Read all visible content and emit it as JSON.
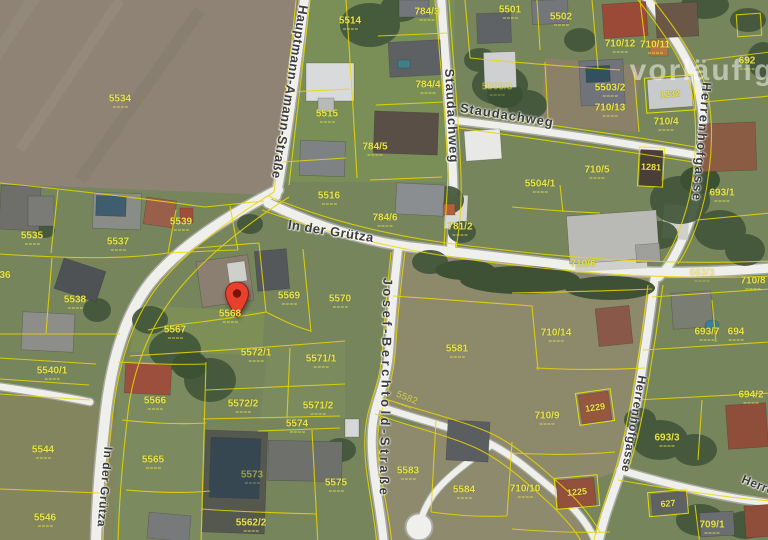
{
  "map": {
    "watermark": {
      "text": "vorläufig",
      "x": 702,
      "y": 71
    },
    "marker": {
      "x": 224,
      "y": 281
    },
    "streets": [
      {
        "name": "Hauptmann-Amann-Straße",
        "x": 290,
        "y": 92,
        "rot": 99,
        "fs": 13,
        "ls": 0.5
      },
      {
        "name": "Staudachweg",
        "x": 452,
        "y": 116,
        "rot": 87,
        "fs": 13,
        "ls": 1
      },
      {
        "name": "Staudachweg",
        "x": 507,
        "y": 115,
        "rot": 9,
        "fs": 13,
        "ls": 1
      },
      {
        "name": "In der Grütza",
        "x": 331,
        "y": 231,
        "rot": 9,
        "fs": 13,
        "ls": 0.5
      },
      {
        "name": "In der Grütza",
        "x": 105,
        "y": 487,
        "rot": 95,
        "fs": 12,
        "ls": 0.5
      },
      {
        "name": "Josef-Berchtold-Straße",
        "x": 386,
        "y": 388,
        "rot": 91,
        "fs": 13,
        "ls": 3.5
      },
      {
        "name": "Herrenhofgasse",
        "x": 702,
        "y": 142,
        "rot": 95,
        "fs": 13,
        "ls": 1.5
      },
      {
        "name": "Herrenhofgasse",
        "x": 634,
        "y": 424,
        "rot": 100,
        "fs": 12,
        "ls": 0.5
      },
      {
        "name": "Herrenhofgasse",
        "x": 788,
        "y": 497,
        "rot": 22,
        "fs": 12,
        "ls": 0.5
      }
    ],
    "parcels": [
      {
        "num": "5534",
        "x": 120,
        "y": 101
      },
      {
        "num": "5514",
        "x": 350,
        "y": 23
      },
      {
        "num": "5515",
        "x": 327,
        "y": 116
      },
      {
        "num": "5516",
        "x": 329,
        "y": 198
      },
      {
        "num": "784/3",
        "x": 427,
        "y": 14
      },
      {
        "num": "784/4",
        "x": 428,
        "y": 87
      },
      {
        "num": "784/5",
        "x": 375,
        "y": 149
      },
      {
        "num": "784/6",
        "x": 385,
        "y": 220
      },
      {
        "num": "781/2",
        "x": 460,
        "y": 229
      },
      {
        "num": "5501",
        "x": 510,
        "y": 12
      },
      {
        "num": "5502",
        "x": 561,
        "y": 19
      },
      {
        "num": "5503/3",
        "x": 497,
        "y": 89,
        "dim": true
      },
      {
        "num": "5503/2",
        "x": 610,
        "y": 90
      },
      {
        "num": "710/12",
        "x": 620,
        "y": 46
      },
      {
        "num": "710/11",
        "x": 655,
        "y": 47
      },
      {
        "num": "710/13",
        "x": 610,
        "y": 110
      },
      {
        "num": "710/4",
        "x": 666,
        "y": 124
      },
      {
        "num": "710/5",
        "x": 597,
        "y": 172
      },
      {
        "num": "692",
        "x": 747,
        "y": 63
      },
      {
        "num": "693/1",
        "x": 722,
        "y": 195
      },
      {
        "num": "5504/1",
        "x": 540,
        "y": 186
      },
      {
        "num": "710/6",
        "x": 583,
        "y": 266
      },
      {
        "num": "683/3",
        "x": 702,
        "y": 275,
        "dim": true
      },
      {
        "num": "710/8",
        "x": 753,
        "y": 283
      },
      {
        "num": "710/14",
        "x": 556,
        "y": 335
      },
      {
        "num": "693/7",
        "x": 707,
        "y": 334
      },
      {
        "num": "694",
        "x": 736,
        "y": 334
      },
      {
        "num": "5581",
        "x": 457,
        "y": 351
      },
      {
        "num": "5567",
        "x": 175,
        "y": 332
      },
      {
        "num": "5568",
        "x": 230,
        "y": 316
      },
      {
        "num": "5569",
        "x": 289,
        "y": 298
      },
      {
        "num": "5570",
        "x": 340,
        "y": 301
      },
      {
        "num": "5535",
        "x": 32,
        "y": 238
      },
      {
        "num": "36",
        "x": 5,
        "y": 276,
        "dash": false
      },
      {
        "num": "5537",
        "x": 118,
        "y": 244
      },
      {
        "num": "5538",
        "x": 75,
        "y": 302
      },
      {
        "num": "5539",
        "x": 181,
        "y": 224
      },
      {
        "num": "5540/1",
        "x": 52,
        "y": 373
      },
      {
        "num": "5544",
        "x": 43,
        "y": 452
      },
      {
        "num": "5546",
        "x": 45,
        "y": 520
      },
      {
        "num": "5565",
        "x": 153,
        "y": 462
      },
      {
        "num": "5566",
        "x": 155,
        "y": 403
      },
      {
        "num": "5571/1",
        "x": 321,
        "y": 361
      },
      {
        "num": "5571/2",
        "x": 318,
        "y": 408
      },
      {
        "num": "5572/1",
        "x": 256,
        "y": 355
      },
      {
        "num": "5572/2",
        "x": 243,
        "y": 406
      },
      {
        "num": "5573",
        "x": 252,
        "y": 477,
        "dim": true
      },
      {
        "num": "5574",
        "x": 297,
        "y": 426
      },
      {
        "num": "5575",
        "x": 336,
        "y": 485
      },
      {
        "num": "5582",
        "x": 406,
        "y": 400,
        "rot": 22,
        "dim": true
      },
      {
        "num": "5583",
        "x": 408,
        "y": 473
      },
      {
        "num": "5584",
        "x": 464,
        "y": 492
      },
      {
        "num": "5562/2",
        "x": 251,
        "y": 525
      },
      {
        "num": "710/9",
        "x": 547,
        "y": 418
      },
      {
        "num": "710/10",
        "x": 525,
        "y": 491
      },
      {
        "num": "709/1",
        "x": 712,
        "y": 527
      },
      {
        "num": "694/2",
        "x": 751,
        "y": 397
      },
      {
        "num": "693/3",
        "x": 667,
        "y": 440
      }
    ],
    "outlined_buildings": [
      {
        "num": "1232",
        "x": 670,
        "y": 94,
        "w": 48,
        "h": 34,
        "rot": -4
      },
      {
        "num": "1281",
        "x": 651,
        "y": 167,
        "w": 24,
        "h": 38,
        "rot": 3
      },
      {
        "num": "1229",
        "x": 595,
        "y": 407,
        "w": 34,
        "h": 31,
        "rot": -8
      },
      {
        "num": "1225",
        "x": 577,
        "y": 492,
        "w": 42,
        "h": 30,
        "rot": -5
      },
      {
        "num": "627",
        "x": 668,
        "y": 503,
        "w": 38,
        "h": 23,
        "rot": -5
      }
    ]
  }
}
